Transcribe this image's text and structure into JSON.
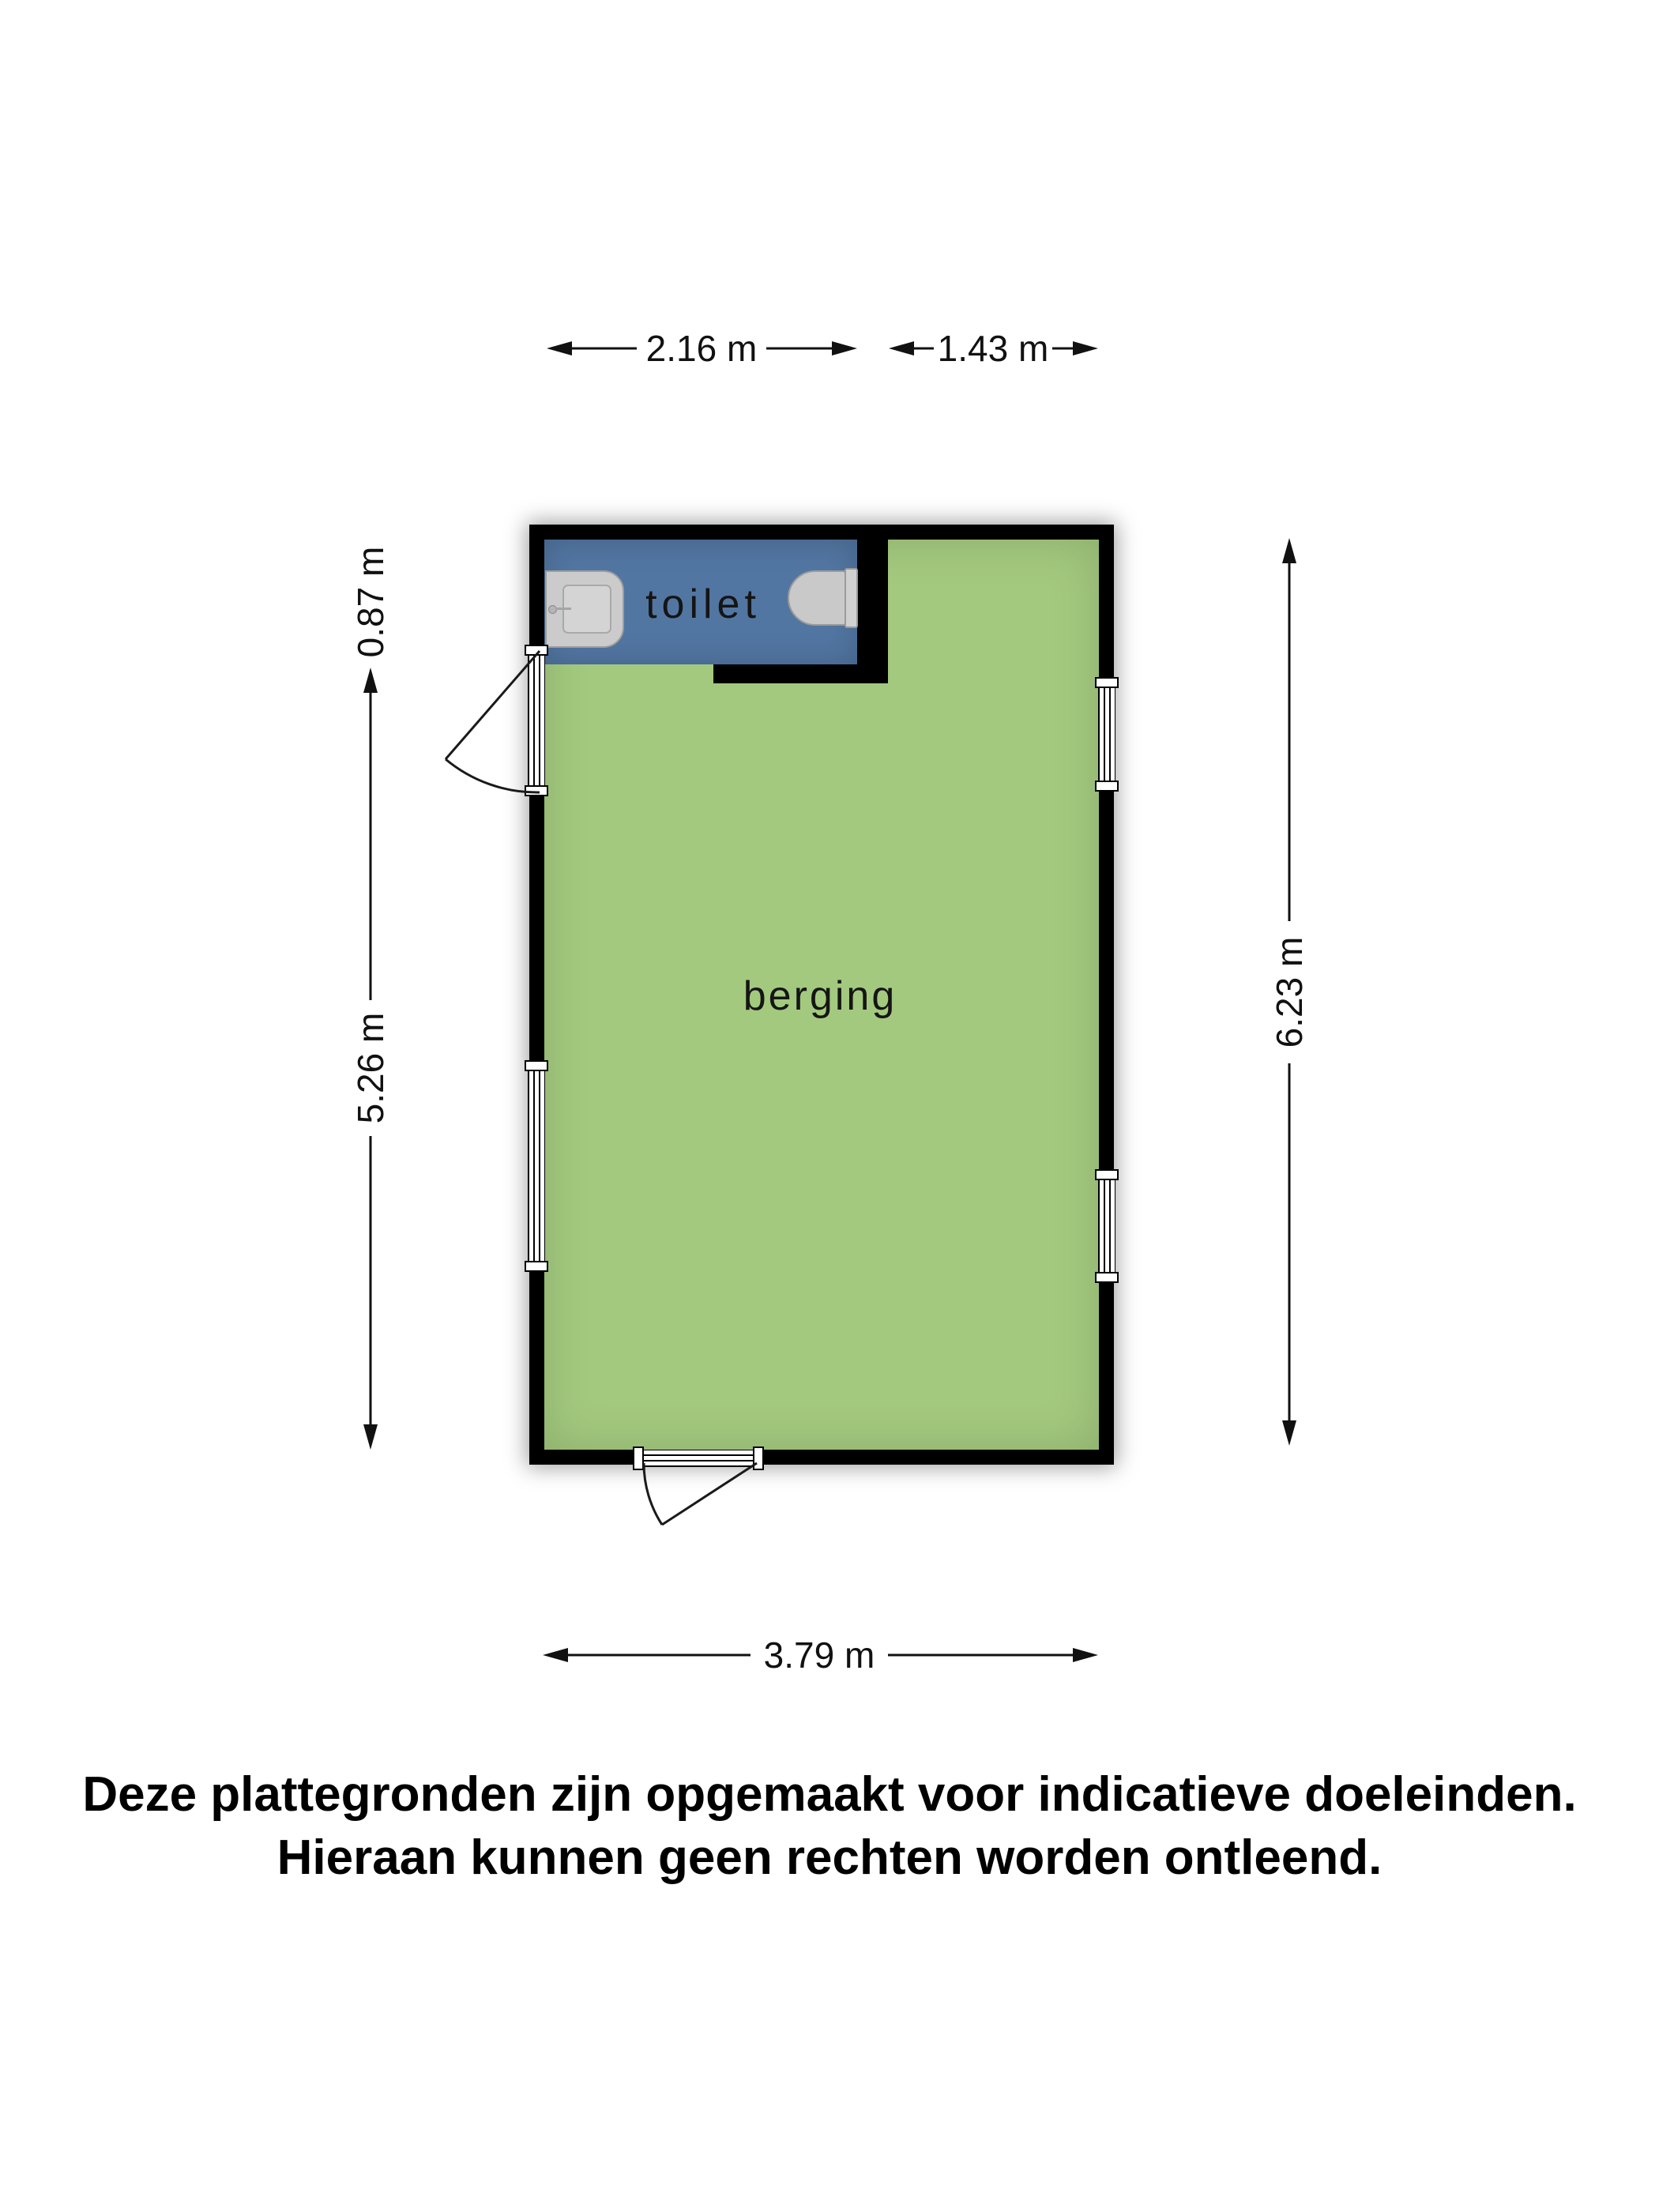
{
  "plan": {
    "rooms": [
      {
        "id": "toilet",
        "label": "toilet"
      },
      {
        "id": "berging",
        "label": "berging"
      }
    ],
    "fixtures": [
      {
        "icon": "sink-icon"
      },
      {
        "icon": "toilet-bowl-icon"
      }
    ],
    "openings": [
      {
        "type": "door",
        "wall": "left"
      },
      {
        "type": "window",
        "wall": "left"
      },
      {
        "type": "window",
        "wall": "right-upper"
      },
      {
        "type": "window",
        "wall": "right-lower"
      },
      {
        "type": "door",
        "wall": "bottom"
      }
    ]
  },
  "dimensions": {
    "top_left": "2.16 m",
    "top_right": "1.43 m",
    "left_top": "0.87 m",
    "left_bottom": "5.26 m",
    "right": "6.23 m",
    "bottom": "3.79 m"
  },
  "disclaimer": {
    "line1": "Deze plattegronden zijn opgemaakt voor indicatieve doeleinden.",
    "line2": "Hieraan kunnen geen rechten worden ontleend."
  },
  "colors": {
    "room_green": "#a3c97e",
    "room_blue": "#5276a2",
    "wall": "#000000",
    "fixture_gray": "#cbcbcb",
    "text": "#111111"
  }
}
